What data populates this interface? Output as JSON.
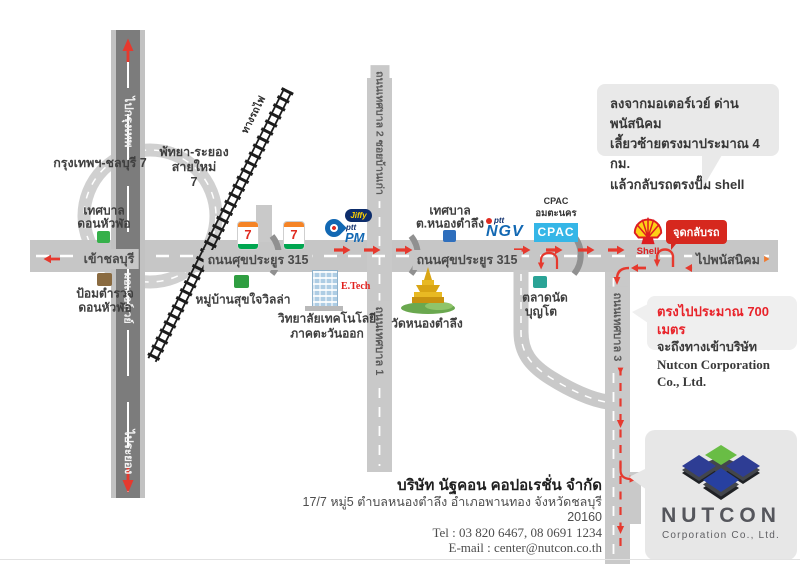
{
  "colors": {
    "road_gray": "#c6c6c6",
    "motorway_dark": "#7c7c7c",
    "route_red": "#e6392e",
    "dest_orange": "#ef7b30",
    "cpac_blue": "#35b6e7",
    "shell_yellow": "#fdd016",
    "shell_red": "#dd1d21",
    "nutcon_blue": "#2e3d94",
    "nutcon_green": "#69bd45",
    "badge_red": "#d6281e"
  },
  "roads": {
    "motorway_to_top": "ไปกรุงเทพ",
    "motorway_name": "มอเตอร์เวย์",
    "motorway_to_bottom": "ไประยอง",
    "main_to_west": "เข้าชลบุรี",
    "main_name_west": "ถนนศุขประยูร 315",
    "main_name_center": "ถนนศุขประยูร 315",
    "main_to_east": "ไปพนัสนิคม",
    "north_road_name": "ถนนเทศบาล 2 ซอยบ้านเก่า",
    "south_road_name": "ถนนเทศบาล 1",
    "east_south_road_name": "ถนนเทศบาล 3",
    "railway_name": "ทางรถไฟ",
    "interchange_west": "กรุงเทพฯ-ชลบุรี 7",
    "interchange_east_line1": "พัทยา-ระยอง",
    "interchange_east_line2": "สายใหม่",
    "interchange_east_line3": "7"
  },
  "places": {
    "tessaban_dhl_line1": "เทศบาล",
    "tessaban_dhl_line2": "ดอนหัวฬ่อ",
    "police_line1": "ป้อมตำรวจ",
    "police_line2": "ดอนหัวฬ่อ",
    "sukjai_villa": "หมู่บ้านสุขใจวิลล่า",
    "seven": "7",
    "jiffy": "Jiffy",
    "ptt": "ptt",
    "pm": "PM",
    "ngv_ptt": "ptt",
    "ngv": "NGV",
    "cpac_title": "CPAC",
    "cpac_area": "อมตะนคร",
    "cpac_box": "CPAC",
    "etech": "E.Tech",
    "college_line1": "วิทยาลัยเทคโนโลยี",
    "college_line2": "ภาคตะวันออก",
    "temple": "วัดหนองตำลึง",
    "tessaban_nt_line1": "เทศบาล",
    "tessaban_nt_line2": "ต.หนองตำลึง",
    "market_line1": "ตลาดนัด",
    "market_line2": "บุญโต",
    "shell": "Shell",
    "uturn_badge": "จุดกลับรถ"
  },
  "bubbles": {
    "directions_line1": "ลงจากมอเตอร์เวย์ ด่านพนัสนิคม",
    "directions_line2": "เลี้ยวซ้ายตรงมาประมาณ 4 กม.",
    "directions_line3": "แล้วกลับรถตรงปั๊ม shell",
    "distance_line1": "ตรงไปประมาณ 700 เมตร",
    "distance_line2": "จะถึงทางเข้าบริษัท",
    "distance_line3": "Nutcon Corporation Co., Ltd."
  },
  "company": {
    "name_th": "บริษัท นัฐคอน คอปอเรชั่น จำกัด",
    "address": "17/7 หมู่5 ตำบลหนองตำลึง อำเภอพานทอง จังหวัดชลบุรี 20160",
    "tel": "Tel : 03 820 6467, 08 0691 1234",
    "email": "E-mail : center@nutcon.co.th",
    "logo_name": "NUTCON",
    "logo_sub": "Corporation Co., Ltd."
  }
}
